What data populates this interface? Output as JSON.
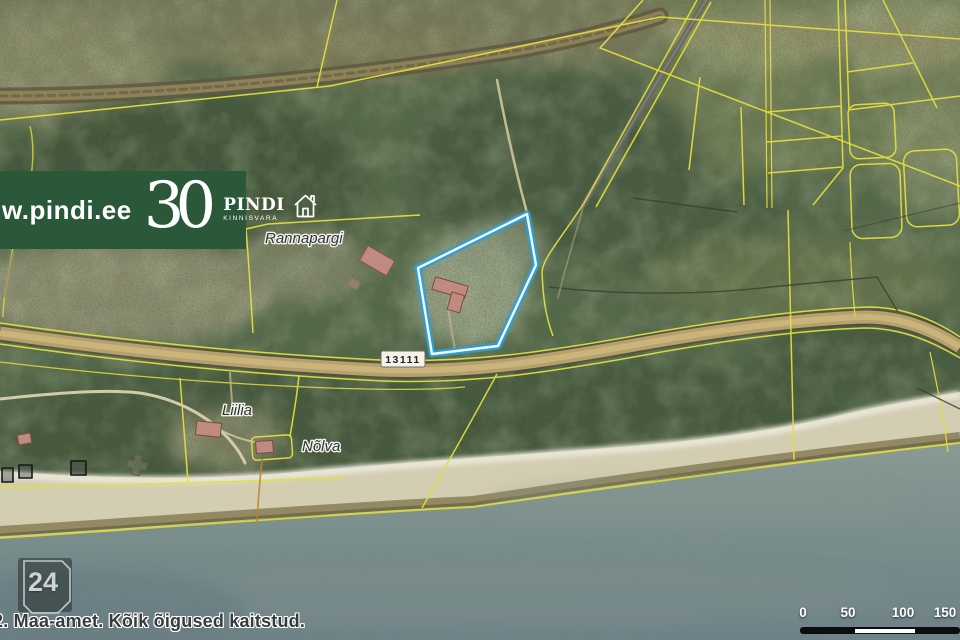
{
  "logo": {
    "website": "w.pindi.ee",
    "anniversary": "30",
    "brand": "PINDI",
    "brand_sub": "KINNISVARA",
    "bg_color": "#2a5839"
  },
  "map": {
    "place_labels": {
      "rannapargi": "Rannapargi",
      "liilia": "Liilia",
      "nolva": "Nõlva"
    },
    "road_number": "13111",
    "highlight_color": "#2d9fd6",
    "parcel_line_color": "#e3df3d"
  },
  "badge": {
    "number": "24"
  },
  "attribution": {
    "text": "2. Maa-amet. Kõik õigused kaitstud."
  },
  "scalebar": {
    "labels": [
      "0",
      "50",
      "100",
      "150"
    ]
  }
}
